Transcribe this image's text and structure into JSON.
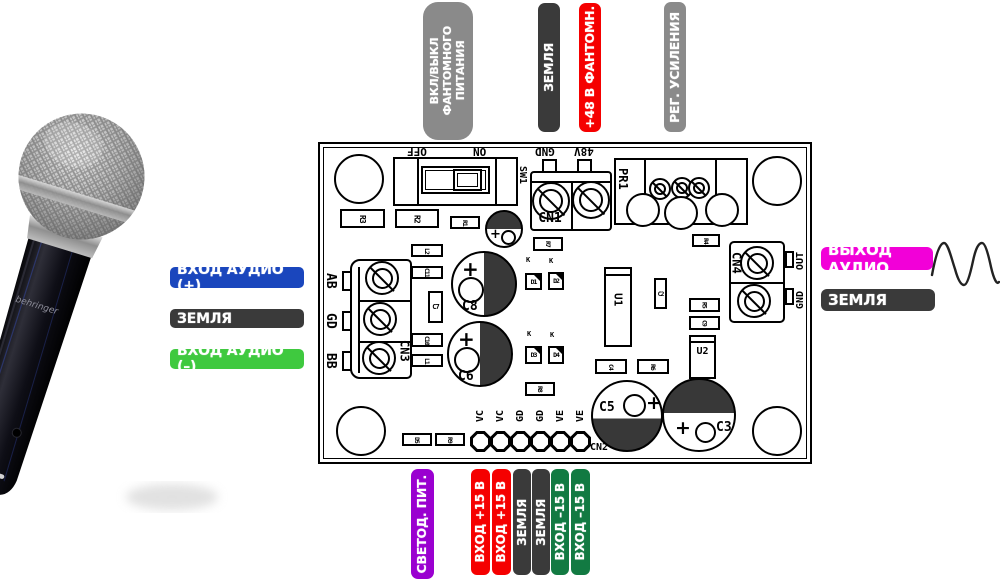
{
  "colors": {
    "gray": "#8a8a8a",
    "dark": "#3a3a3a",
    "red": "#f50000",
    "blue": "#1a46bd",
    "green_bright": "#3fc93f",
    "green_dark": "#127a42",
    "purple": "#9a00d0",
    "magenta": "#f200d8"
  },
  "top_labels": [
    {
      "text": "ВКЛ/ВЫКЛ\nФАНТОМНОГО\nПИТАНИЯ"
    },
    {
      "text": "ЗЕМЛЯ"
    },
    {
      "text": "+48 В ФАНТОМН."
    },
    {
      "text": "РЕГ. УСИЛЕНИЯ"
    }
  ],
  "left_labels": [
    {
      "text": "ВХОД АУДИО (+)"
    },
    {
      "text": "ЗЕМЛЯ"
    },
    {
      "text": "ВХОД АУДИО (–)"
    }
  ],
  "right_labels": [
    {
      "text": "ВЫХОД АУДИО"
    },
    {
      "text": "ЗЕМЛЯ"
    }
  ],
  "bottom_labels": [
    {
      "text": "СВЕТОД. ПИТ."
    },
    {
      "text": "ВХОД +15 В"
    },
    {
      "text": "ВХОД +15 В"
    },
    {
      "text": "ЗЕМЛЯ"
    },
    {
      "text": "ЗЕМЛЯ"
    },
    {
      "text": "ВХОД –15 В"
    },
    {
      "text": "ВХОД –15 В"
    }
  ],
  "mic": {
    "brand": "behringer"
  },
  "pcb": {
    "switch": {
      "label": "SW1",
      "off": "OFF",
      "on": "ON"
    },
    "cn1": {
      "label": "CN1",
      "pin1": "GND",
      "pin2": "48V"
    },
    "pr1": {
      "label": "PR1"
    },
    "cn3": {
      "label": "CN3",
      "pins": [
        "AB",
        "GD",
        "BB"
      ]
    },
    "cn4": {
      "label": "CN4",
      "pins": [
        "OUT",
        "GND"
      ]
    },
    "cn2": {
      "label": "CN2",
      "pins": [
        "VC",
        "VC",
        "GD",
        "GD",
        "VE",
        "VE"
      ]
    },
    "u1": "U1",
    "u2": "U2",
    "caps": {
      "c8": "C8",
      "c6": "C6",
      "c5": "C5",
      "c3": "C3"
    },
    "r": {
      "r1": "R1",
      "r2": "R2",
      "r3": "R3",
      "r4": "R4",
      "r5": "R5",
      "r6": "R6",
      "r7": "R7",
      "r8": "R8",
      "r9": "R9"
    },
    "small": {
      "l1": "L1",
      "l2": "L2",
      "c2": "C2",
      "c4": "C4",
      "c7": "C7",
      "c9": "C9",
      "c10": "C10",
      "c11": "C11"
    },
    "d": {
      "d1": "D1",
      "d2": "D2",
      "d3": "D3",
      "d4": "D4",
      "d5": "D5"
    },
    "k": "K",
    "plus": "+"
  }
}
